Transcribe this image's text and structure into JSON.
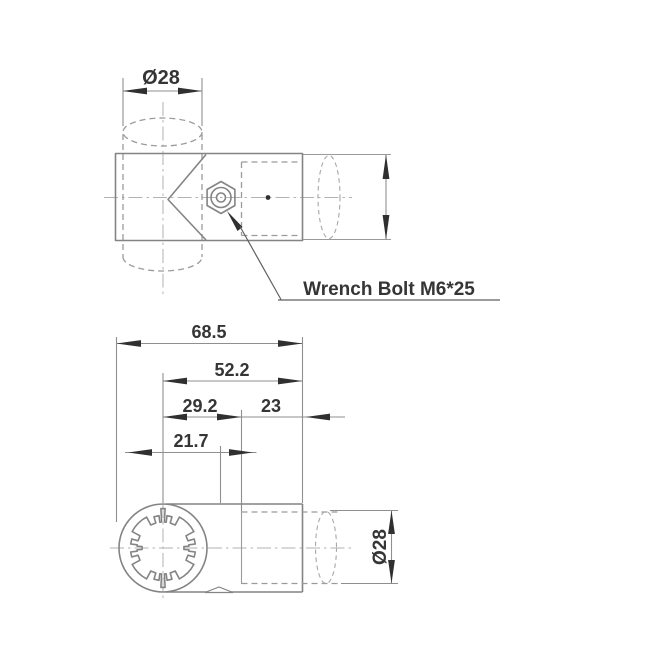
{
  "meta": {
    "background_color": "#ffffff",
    "line_color": "#848484",
    "text_color": "#353535"
  },
  "callout": {
    "label": "Wrench Bolt M6*25"
  },
  "top_view": {
    "pipe_diameter": "Ø28"
  },
  "bottom_view": {
    "overall_width": "68.5",
    "center_to_right_end": "52.2",
    "center_to_pipe_socket": "29.2",
    "pipe_insertion_depth": "23",
    "center_to_bolt_axis": "21.7",
    "pipe_diameter": "Ø28"
  }
}
